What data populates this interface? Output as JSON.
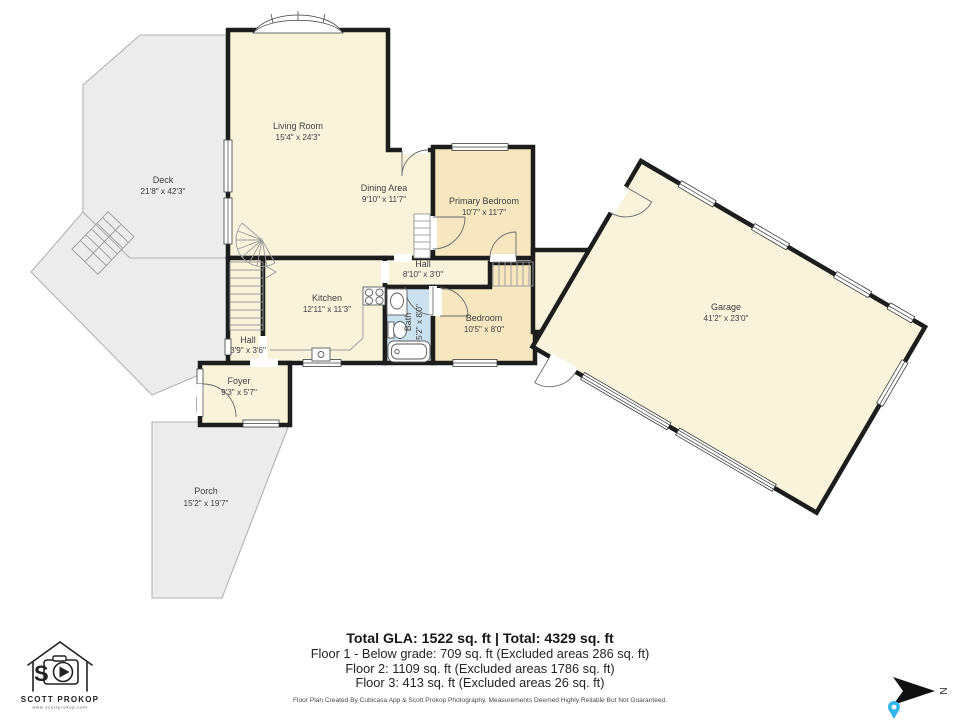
{
  "palette": {
    "wall": "#1d1d1d",
    "room_fill": "#faf3db",
    "bedroom_fill": "#f6e7c0",
    "bath_fill": "#cbe1f0",
    "outdoor_fill": "#ececec",
    "outdoor_stroke": "#b3b3b3",
    "pin_blue": "#35b6e8"
  },
  "rooms": [
    {
      "id": "living-room",
      "name": "Living Room",
      "dims": "15'4\" x 24'3\""
    },
    {
      "id": "dining-area",
      "name": "Dining Area",
      "dims": "9'10\" x 11'7\""
    },
    {
      "id": "primary-bedroom",
      "name": "Primary Bedroom",
      "dims": "10'7\" x 11'7\""
    },
    {
      "id": "deck",
      "name": "Deck",
      "dims": "21'8\" x 42'3\""
    },
    {
      "id": "hall-upper",
      "name": "Hall",
      "dims": "8'10\" x 3'0\""
    },
    {
      "id": "kitchen",
      "name": "Kitchen",
      "dims": "12'11\" x 11'3\""
    },
    {
      "id": "bath",
      "name": "Bath",
      "dims": "5'2\" x 8'0\""
    },
    {
      "id": "bedroom",
      "name": "Bedroom",
      "dims": "10'5\" x 8'0\""
    },
    {
      "id": "hall-lower",
      "name": "Hall",
      "dims": "3'9\" x 3'6\""
    },
    {
      "id": "foyer",
      "name": "Foyer",
      "dims": "9'3\" x 5'7\""
    },
    {
      "id": "porch",
      "name": "Porch",
      "dims": "15'2\" x 19'7\""
    },
    {
      "id": "garage",
      "name": "Garage",
      "dims": "41'2\" x 23'0\""
    }
  ],
  "summary": {
    "total_line": "Total GLA: 1522 sq. ft | Total: 4329 sq. ft",
    "floor1": "Floor 1 - Below grade: 709 sq. ft (Excluded areas 286 sq. ft)",
    "floor2": "Floor 2: 1109 sq. ft (Excluded areas 1786 sq. ft)",
    "floor3": "Floor 3: 413 sq. ft (Excluded areas 26 sq. ft)",
    "disclaimer": "Floor Plan Created By Cubicasa App & Scott Prokop Photography. Measurements Deemed Highly Reliable But Not Guaranteed."
  },
  "branding": {
    "name": "SCOTT PROKOP",
    "website": "www.scottprokop.com"
  },
  "compass": {
    "label": "N"
  }
}
